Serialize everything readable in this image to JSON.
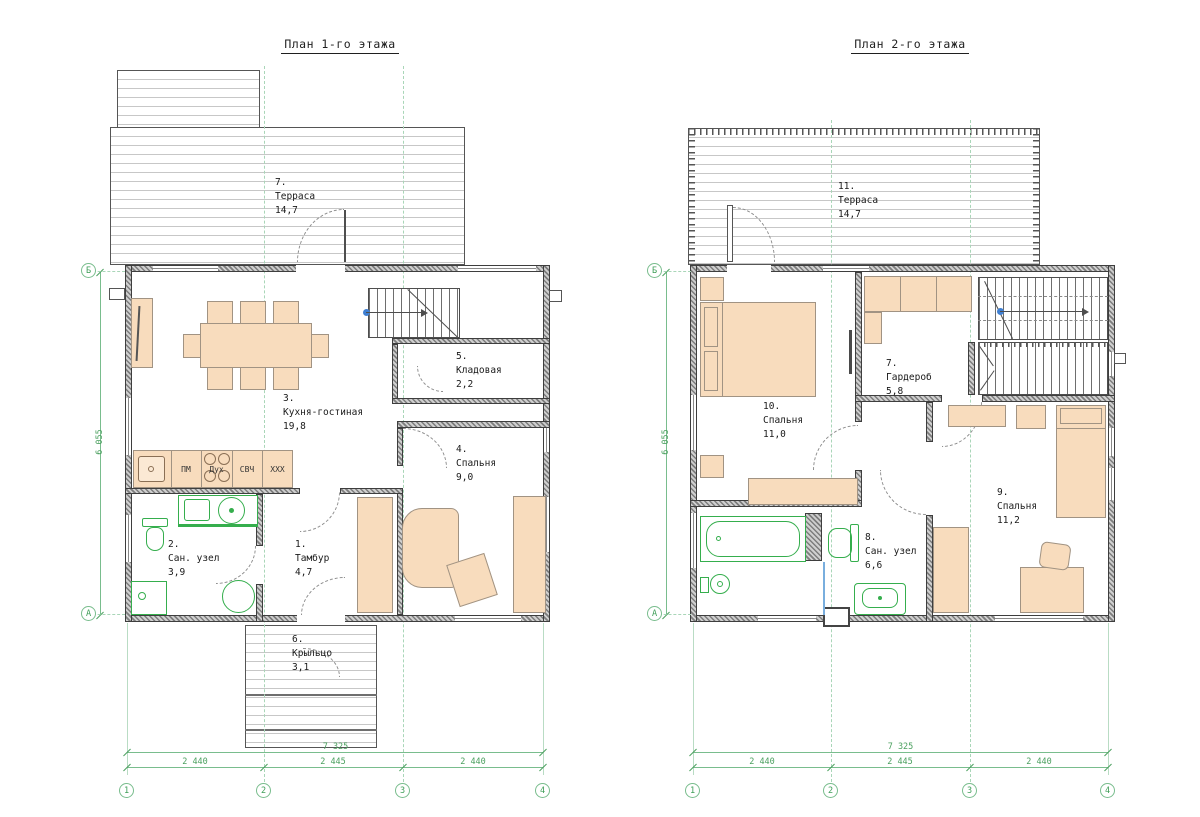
{
  "drawing": {
    "floor1": {
      "title": "План 1-го этажа",
      "rooms": {
        "tambur": {
          "num": "1.",
          "name": "Тамбур",
          "area": "4,7"
        },
        "sanuzel": {
          "num": "2.",
          "name": "Сан. узел",
          "area": "3,9"
        },
        "kitchen": {
          "num": "3.",
          "name": "Кухня-гостиная",
          "area": "19,8"
        },
        "bedroom": {
          "num": "4.",
          "name": "Спальня",
          "area": "9,0"
        },
        "storage": {
          "num": "5.",
          "name": "Кладовая",
          "area": "2,2"
        },
        "porch": {
          "num": "6.",
          "name": "Крыльцо",
          "area": "3,1"
        },
        "terrace": {
          "num": "7.",
          "name": "Терраса",
          "area": "14,7"
        }
      },
      "appliances": {
        "pm": "ПМ",
        "oven": "Дух",
        "micro": "СВЧ",
        "xxx": "XXX"
      }
    },
    "floor2": {
      "title": "План 2-го этажа",
      "rooms": {
        "wardrobe": {
          "num": "7.",
          "name": "Гардероб",
          "area": "5,8"
        },
        "sanuzel": {
          "num": "8.",
          "name": "Сан. узел",
          "area": "6,6"
        },
        "bedroom9": {
          "num": "9.",
          "name": "Спальня",
          "area": "11,2"
        },
        "bedroom10": {
          "num": "10.",
          "name": "Спальня",
          "area": "11,0"
        },
        "terrace": {
          "num": "11.",
          "name": "Терраса",
          "area": "14,7"
        }
      }
    },
    "grid": {
      "cols": [
        "1",
        "2",
        "3",
        "4"
      ],
      "row_top": "Б",
      "row_bottom": "А"
    },
    "dims": {
      "overall_w": "7 325",
      "span_12": "2 440",
      "span_23": "2 445",
      "span_34": "2 440",
      "overall_h": "6 055"
    },
    "colors": {
      "wall": "#4a4a4a",
      "fixture_green": "#35ae4d",
      "dim_green": "#79bd8d",
      "furniture": "#f8dcbd",
      "marker_blue": "#3f7fd2"
    }
  }
}
